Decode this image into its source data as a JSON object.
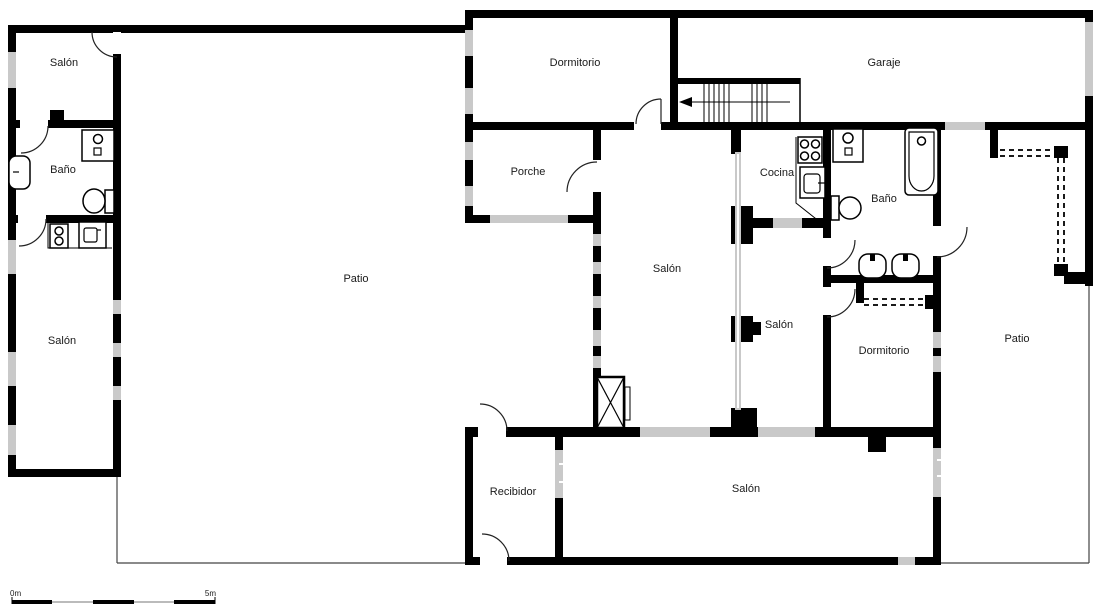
{
  "plan": {
    "type": "floor-plan",
    "rooms": {
      "salon_tl": {
        "label": "Salón"
      },
      "bano_tl": {
        "label": "Baño"
      },
      "salon_bl": {
        "label": "Salón"
      },
      "patio_main": {
        "label": "Patio"
      },
      "dormitorio_top": {
        "label": "Dormitorio"
      },
      "garaje": {
        "label": "Garaje"
      },
      "porche": {
        "label": "Porche"
      },
      "cocina": {
        "label": "Cocina"
      },
      "salon_center": {
        "label": "Salón"
      },
      "salon_mid": {
        "label": "Salón"
      },
      "bano_right": {
        "label": "Baño"
      },
      "dormitorio_right": {
        "label": "Dormitorio"
      },
      "patio_right": {
        "label": "Patio"
      },
      "recibidor": {
        "label": "Recibidor"
      },
      "salon_bottom": {
        "label": "Salón"
      }
    },
    "scale_bar": {
      "start_label": "0m",
      "end_label": "5m"
    },
    "colors": {
      "wall": "#000000",
      "window": "#c9c9c9",
      "boundary": "#444444",
      "text": "#1a1a1a",
      "background": "#ffffff"
    }
  }
}
